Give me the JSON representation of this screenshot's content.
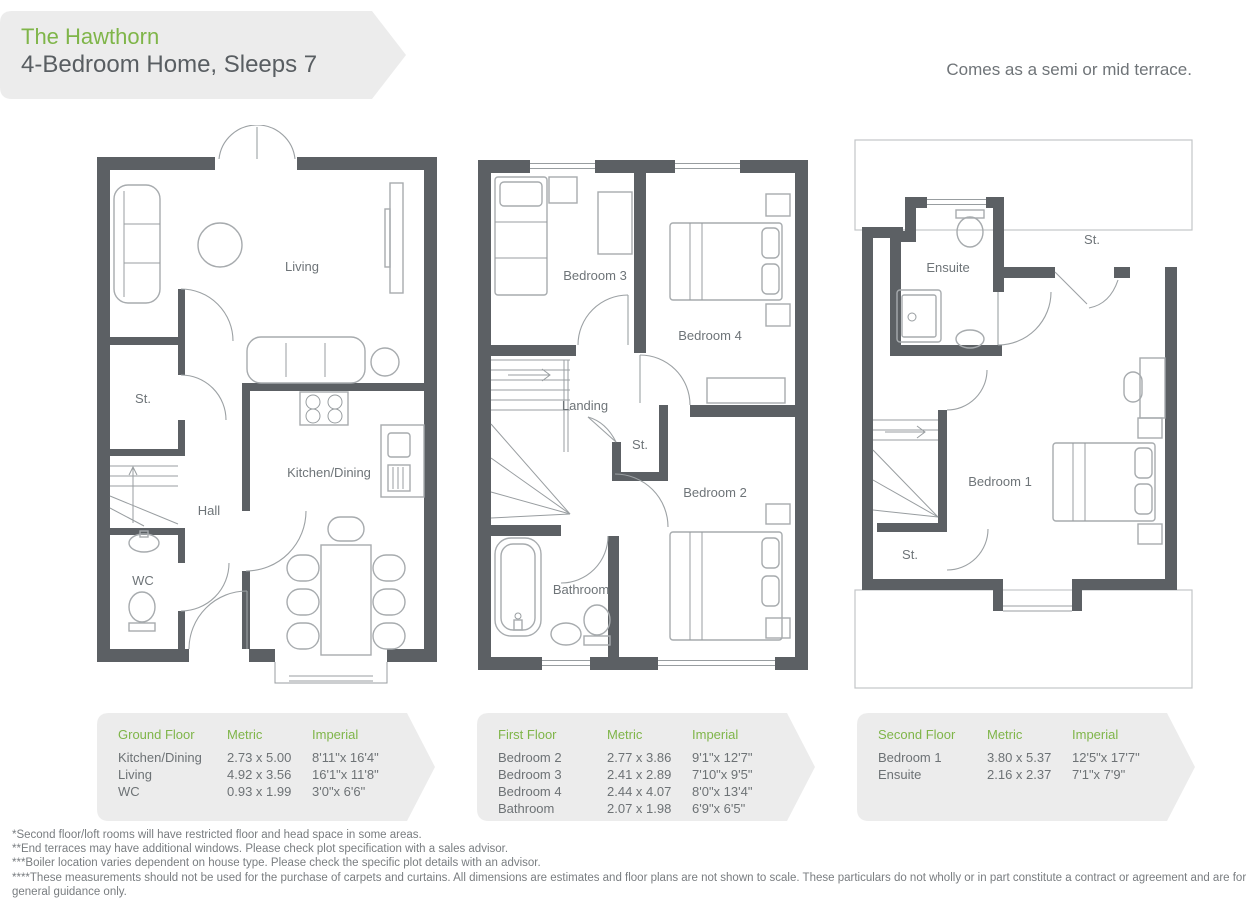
{
  "header": {
    "title": "The Hawthorn",
    "subtitle": "4-Bedroom Home, Sleeps 7",
    "terrace_note": "Comes as a semi or mid terrace."
  },
  "colors": {
    "accent_green": "#7fb549",
    "wall_gray": "#5c6064",
    "panel_gray": "#ececec",
    "text_dark": "#595e62",
    "text_muted": "#6d7275"
  },
  "floors": [
    {
      "name": "Ground Floor",
      "labels": {
        "living": "Living",
        "st": "St.",
        "hall": "Hall",
        "wc": "WC",
        "kitchen": "Kitchen/Dining"
      },
      "table": {
        "title": "Ground Floor",
        "metric_header": "Metric",
        "imperial_header": "Imperial",
        "rows": [
          {
            "room": "Kitchen/Dining",
            "metric": "2.73 x 5.00",
            "imperial": "8'11\"x 16'4\""
          },
          {
            "room": "Living",
            "metric": "4.92 x 3.56",
            "imperial": "16'1\"x 11'8\""
          },
          {
            "room": "WC",
            "metric": "0.93 x 1.99",
            "imperial": "3'0\"x 6'6\""
          }
        ]
      }
    },
    {
      "name": "First Floor",
      "labels": {
        "bedroom3": "Bedroom 3",
        "bedroom4": "Bedroom 4",
        "landing": "Landing",
        "st": "St.",
        "bedroom2": "Bedroom 2",
        "bathroom": "Bathroom"
      },
      "table": {
        "title": "First Floor",
        "metric_header": "Metric",
        "imperial_header": "Imperial",
        "rows": [
          {
            "room": "Bedroom 2",
            "metric": "2.77 x 3.86",
            "imperial": "9'1\"x 12'7\""
          },
          {
            "room": "Bedroom 3",
            "metric": "2.41 x 2.89",
            "imperial": "7'10\"x 9'5\""
          },
          {
            "room": "Bedroom 4",
            "metric": "2.44 x 4.07",
            "imperial": "8'0\"x 13'4\""
          },
          {
            "room": "Bathroom",
            "metric": "2.07 x 1.98",
            "imperial": "6'9\"x 6'5\""
          }
        ]
      }
    },
    {
      "name": "Second Floor",
      "labels": {
        "ensuite": "Ensuite",
        "st_top": "St.",
        "bedroom1": "Bedroom 1",
        "st_bottom": "St."
      },
      "table": {
        "title": "Second Floor",
        "metric_header": "Metric",
        "imperial_header": "Imperial",
        "rows": [
          {
            "room": "Bedroom 1",
            "metric": "3.80 x 5.37",
            "imperial": "12'5\"x 17'7\""
          },
          {
            "room": "Ensuite",
            "metric": "2.16 x 2.37",
            "imperial": "7'1\"x 7'9\""
          }
        ]
      }
    }
  ],
  "footnotes": [
    "*Second floor/loft rooms will have restricted floor and head space in some areas.",
    "**End terraces may have additional windows. Please check plot specification with a sales advisor.",
    "***Boiler location varies dependent on house type. Please check the specific plot details with an advisor.",
    "****These measurements should not be used for the purchase of carpets and curtains. All dimensions are estimates and floor plans are not shown to scale. These particulars do not wholly or in part constitute a contract or agreement and are for general guidance only."
  ]
}
